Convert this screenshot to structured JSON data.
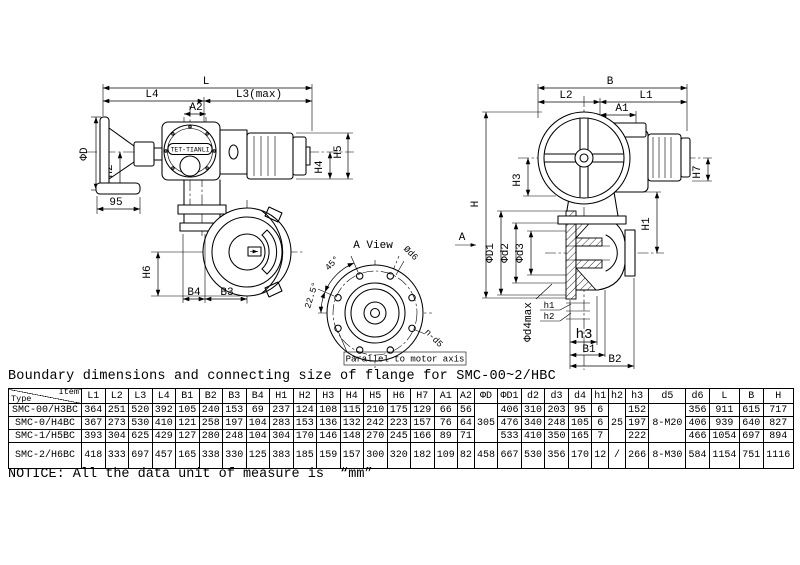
{
  "drawing": {
    "logo": "TET-TIANLI",
    "left_view": {
      "L": "L",
      "L4": "L4",
      "L3": "L3(max)",
      "A2": "A2",
      "phiD": "ΦD",
      "H2": "H2",
      "n95": "95",
      "H4": "H4",
      "H5": "H5",
      "H6": "H6",
      "B4": "B4",
      "B3": "B3"
    },
    "a_view": {
      "title": "A View",
      "deg45": "45°",
      "deg225": "22.5°",
      "od6": "Ød6",
      "nd5": "n-d5",
      "parallel": "Parallel to motor axis"
    },
    "right_view": {
      "B": "B",
      "L2": "L2",
      "L1": "L1",
      "A1": "A1",
      "H": "H",
      "H3": "H3",
      "H7": "H7",
      "H1": "H1",
      "phiD1": "ΦD1",
      "phid2": "Φd2",
      "phid3": "Φd3",
      "phid4max": "Φd4max",
      "h1": "h1",
      "h2": "h2",
      "h3": "h3",
      "B1": "B1",
      "B2": "B2",
      "A": "A"
    }
  },
  "table": {
    "title": "Boundary dimensions and connecting size of flange for SMC-00~2/HBC",
    "corner": {
      "top": "Item",
      "bottom": "Type"
    },
    "columns": [
      "L1",
      "L2",
      "L3",
      "L4",
      "B1",
      "B2",
      "B3",
      "B4",
      "H1",
      "H2",
      "H3",
      "H4",
      "H5",
      "H6",
      "H7",
      "A1",
      "A2",
      "ΦD",
      "ΦD1",
      "d2",
      "d3",
      "d4",
      "h1",
      "h2",
      "h3",
      "d5",
      "d6",
      "L",
      "B",
      "H"
    ],
    "rows": [
      {
        "type": "SMC-00/H3BC",
        "cells": [
          "364",
          "251",
          "520",
          "392",
          "105",
          "240",
          "153",
          "69",
          "237",
          "124",
          "108",
          "115",
          "210",
          "175",
          "129",
          "66",
          "56",
          {
            "t": "305",
            "rs": 3
          },
          "406",
          "310",
          "203",
          "95",
          "6",
          {
            "t": "25",
            "rs": 3
          },
          "152",
          {
            "t": "8-M20",
            "rs": 3
          },
          "356",
          "911",
          "615",
          "717"
        ]
      },
      {
        "type": "SMC-0/H4BC",
        "cells": [
          "367",
          "273",
          "530",
          "410",
          "121",
          "258",
          "197",
          "104",
          "283",
          "153",
          "136",
          "132",
          "242",
          "223",
          "157",
          "76",
          "64",
          null,
          "476",
          "340",
          "248",
          "105",
          "6",
          null,
          "197",
          null,
          "406",
          "939",
          "640",
          "827"
        ]
      },
      {
        "type": "SMC-1/H5BC",
        "cells": [
          "393",
          "304",
          "625",
          "429",
          "127",
          "280",
          "248",
          "104",
          "304",
          "170",
          "146",
          "148",
          "270",
          "245",
          "166",
          "89",
          "71",
          null,
          "533",
          "410",
          "350",
          "165",
          "7",
          null,
          "222",
          null,
          "466",
          "1054",
          "697",
          "894"
        ]
      },
      {
        "type": "SMC-2/H6BC",
        "cells": [
          "418",
          "333",
          "697",
          "457",
          "165",
          "338",
          "330",
          "125",
          "383",
          "185",
          "159",
          "157",
          "300",
          "320",
          "182",
          "109",
          "82",
          "458",
          "667",
          "530",
          "356",
          "170",
          "12",
          "/",
          "266",
          "8-M30",
          "584",
          "1154",
          "751",
          "1116"
        ]
      }
    ],
    "notice": "NOTICE: All the data unit of measure is  “mm”"
  }
}
